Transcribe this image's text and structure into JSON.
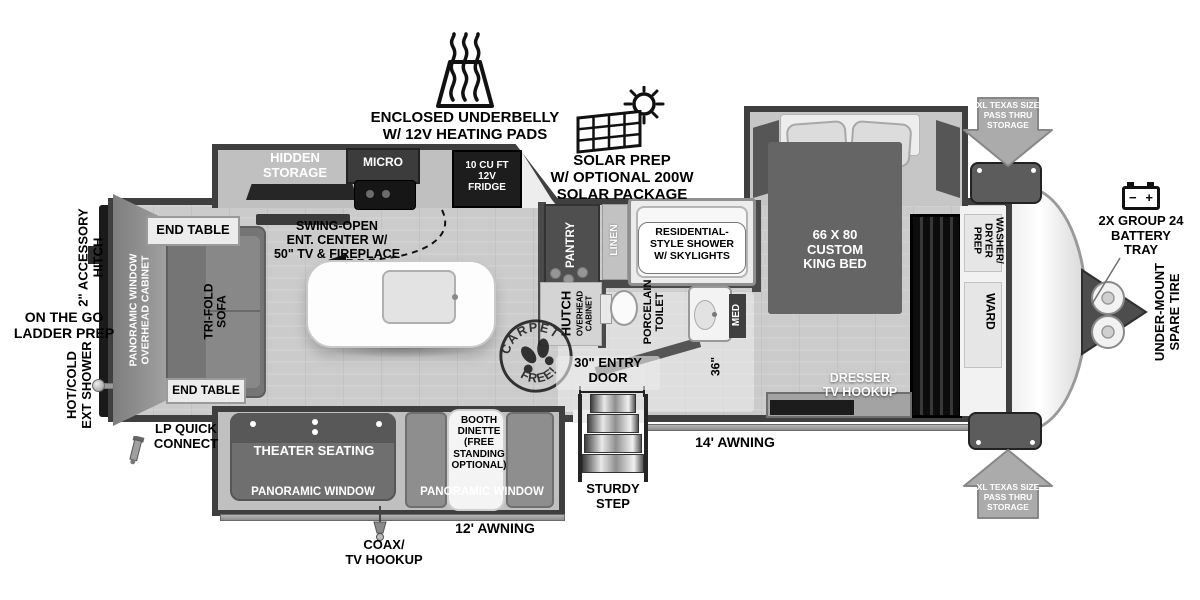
{
  "diagram_type": "travel-trailer floor plan",
  "callouts": {
    "underbelly": "ENCLOSED UNDERBELLY\nW/ 12V HEATING PADS",
    "solar": "SOLAR PREP\nW/ OPTIONAL 200W\nSOLAR PACKAGE",
    "pass_thru": "XL TEXAS SIZE\nPASS THRU\nSTORAGE",
    "battery": "2X GROUP 24\nBATTERY\nTRAY",
    "spare_tire": "UNDER-MOUNT\nSPARE TIRE",
    "accessory_hitch": "2\" ACCESSORY\nHITCH",
    "ladder_prep": "ON THE GO\nLADDER PREP",
    "ext_shower": "HOT/COLD\nEXT SHOWER",
    "lp_quick": "LP QUICK\nCONNECT",
    "coax": "COAX/\nTV HOOKUP",
    "awning_12": "12' AWNING",
    "awning_14": "14' AWNING",
    "entry_door": "30\" ENTRY\nDOOR",
    "sturdy_step": "STURDY\nSTEP",
    "dim_36": "36\""
  },
  "rooms": {
    "kitchen": {
      "hidden_storage": "HIDDEN\nSTORAGE",
      "micro": "MICRO",
      "fridge": "10 CU FT\n12V\nFRIDGE",
      "swing_open": "SWING-OPEN\nENT. CENTER W/\n50\" TV & FIREPLACE"
    },
    "living": {
      "end_table": "END TABLE",
      "sofa": "TRI-FOLD\nSOFA",
      "rear_wall": "PANORAMIC WINDOW\nOVERHEAD CABINET",
      "theater": "THEATER SEATING",
      "dinette": "BOOTH\nDINETTE\n(FREE\nSTANDING\nOPTIONAL)",
      "pano_window": "PANORAMIC WINDOW"
    },
    "bath": {
      "pantry": "PANTRY",
      "linen": "LINEN",
      "shower": "RESIDENTIAL-\nSTYLE SHOWER\nW/ SKYLIGHTS",
      "hutch": "HUTCH",
      "overhead": "OVERHEAD\nCABINET",
      "toilet": "PORCELAIN\nTOILET",
      "med": "MED"
    },
    "bedroom": {
      "bed": "66 X 80\nCUSTOM\nKING BED",
      "dresser": "DRESSER\nTV HOOKUP",
      "washer": "WASHER/\nDRYER\nPREP",
      "ward": "WARD"
    }
  },
  "stamp": {
    "top": "CARPET",
    "bottom": "FREE!"
  },
  "icons": {
    "heating_pads_icon": "trapezoid-pad-with-steam-waves",
    "solar_prep_icon": "solar-panel-grid-with-sun",
    "battery_icon": "battery-box",
    "battery_minus": "−",
    "battery_plus": "+",
    "pass_thru_arrow_down": "block-arrow-down",
    "pass_thru_arrow_up": "block-arrow-up",
    "carpet_free_stamp": "circular-stamp-with-shoeprints",
    "entry_steps_icon": "four-metal-stair-treads",
    "propane_hitch_icon": "a-frame-with-two-tanks",
    "ext_shower_knob_icon": "round-knob",
    "lp_connector_icon": "nozzle",
    "swing_arrow_icon": "dashed-curved-arrow",
    "coax_jack_icon": "cable-connector"
  },
  "colors": {
    "wall": "#3f3f3f",
    "floor": "#cbcbcb",
    "slide_floor": "#c0c0c0",
    "dark_fixture": "#1d1d1d",
    "mid_gray": "#757575",
    "arrow_gray": "#ababab",
    "storage_box": "#5c5c5c",
    "white": "#ffffff",
    "text_dark": "#000000"
  }
}
